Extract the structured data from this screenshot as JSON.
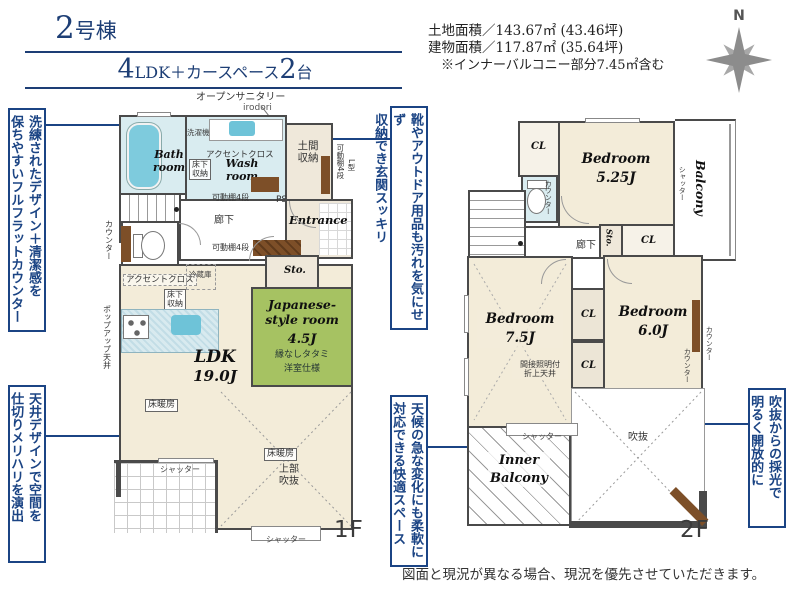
{
  "header": {
    "building_no": {
      "num": "2",
      "suffix": "号棟"
    },
    "layout": {
      "num1": "4",
      "mid": "LDK＋カースペース",
      "num2": "2",
      "tail": "台"
    },
    "land_area": "土地面積／143.67㎡ (43.46坪)",
    "building_area": "建物面積／117.87㎡ (35.64坪)",
    "area_note": "※インナーバルコニー部分7.45㎡含む",
    "compass_n": "N"
  },
  "callouts": {
    "counter": "洗練されたデザイン＋清潔感を\n保ちやすいフルフラットカウンター",
    "ceiling": "天井デザインで空間を\n仕切りメリハリを演出",
    "genkan": "靴やアウトドア用品も汚れを気にせず\n収納でき玄関スッキリ",
    "inner_balcony": "天候の急な変化にも柔軟に\n対応できる快適スペース",
    "void_light": "吹抜からの採光で\n明るく開放的に"
  },
  "common": {
    "cl": "CL",
    "counter": "カウンター",
    "shutter": "シャッター",
    "shelf": "可動棚4段",
    "floor_heating": "床暖房",
    "accent_cloth": "アクセントクロス",
    "underfloor": "床下\n収納"
  },
  "floor1": {
    "open_sanitary": "オープンサニタリー",
    "irodori": "irodori",
    "bath": "Bath\nroom",
    "washer": "洗濯機",
    "wash": "Wash\nroom",
    "genkan_storage": "土間\n収納",
    "l_shape": "L型",
    "ps": "PS",
    "up": "UP",
    "hallway": "廊下",
    "entrance": "Entrance",
    "sto": "Sto.",
    "fridge": "冷蔵庫",
    "popup_ceiling": "ポップアップ天井",
    "ldk": "LDK",
    "ldk_size": "19.0J",
    "jp_room": "Japanese-\nstyle room",
    "jp_size": "4.5J",
    "tatami_note1": "縁なしタタミ",
    "tatami_note2": "洋室仕様",
    "upper_void": "上部\n吹抜",
    "label": "1F"
  },
  "floor2": {
    "bed1": "Bedroom\n5.25J",
    "bed2": "Bedroom\n7.5J",
    "bed3": "Bedroom\n6.0J",
    "balcony": "Balcony",
    "dn": "DN",
    "hallway": "廊下",
    "sto": "Sto.",
    "ceiling_note": "間接照明付\n折上天井",
    "void": "吹抜",
    "inner_balcony": "Inner\nBalcony",
    "label": "2F"
  },
  "footer": {
    "disclaimer": "図面と現況が異なる場合、現況を優先させていただきます。"
  },
  "colors": {
    "accent": "#1b4484",
    "wall": "#4a4a4a",
    "floor": "#f3ecd9",
    "tatami": "#a6c262",
    "water": "#d9ecf0",
    "wood": "#7d4f28",
    "navy": "#1d3e75"
  }
}
